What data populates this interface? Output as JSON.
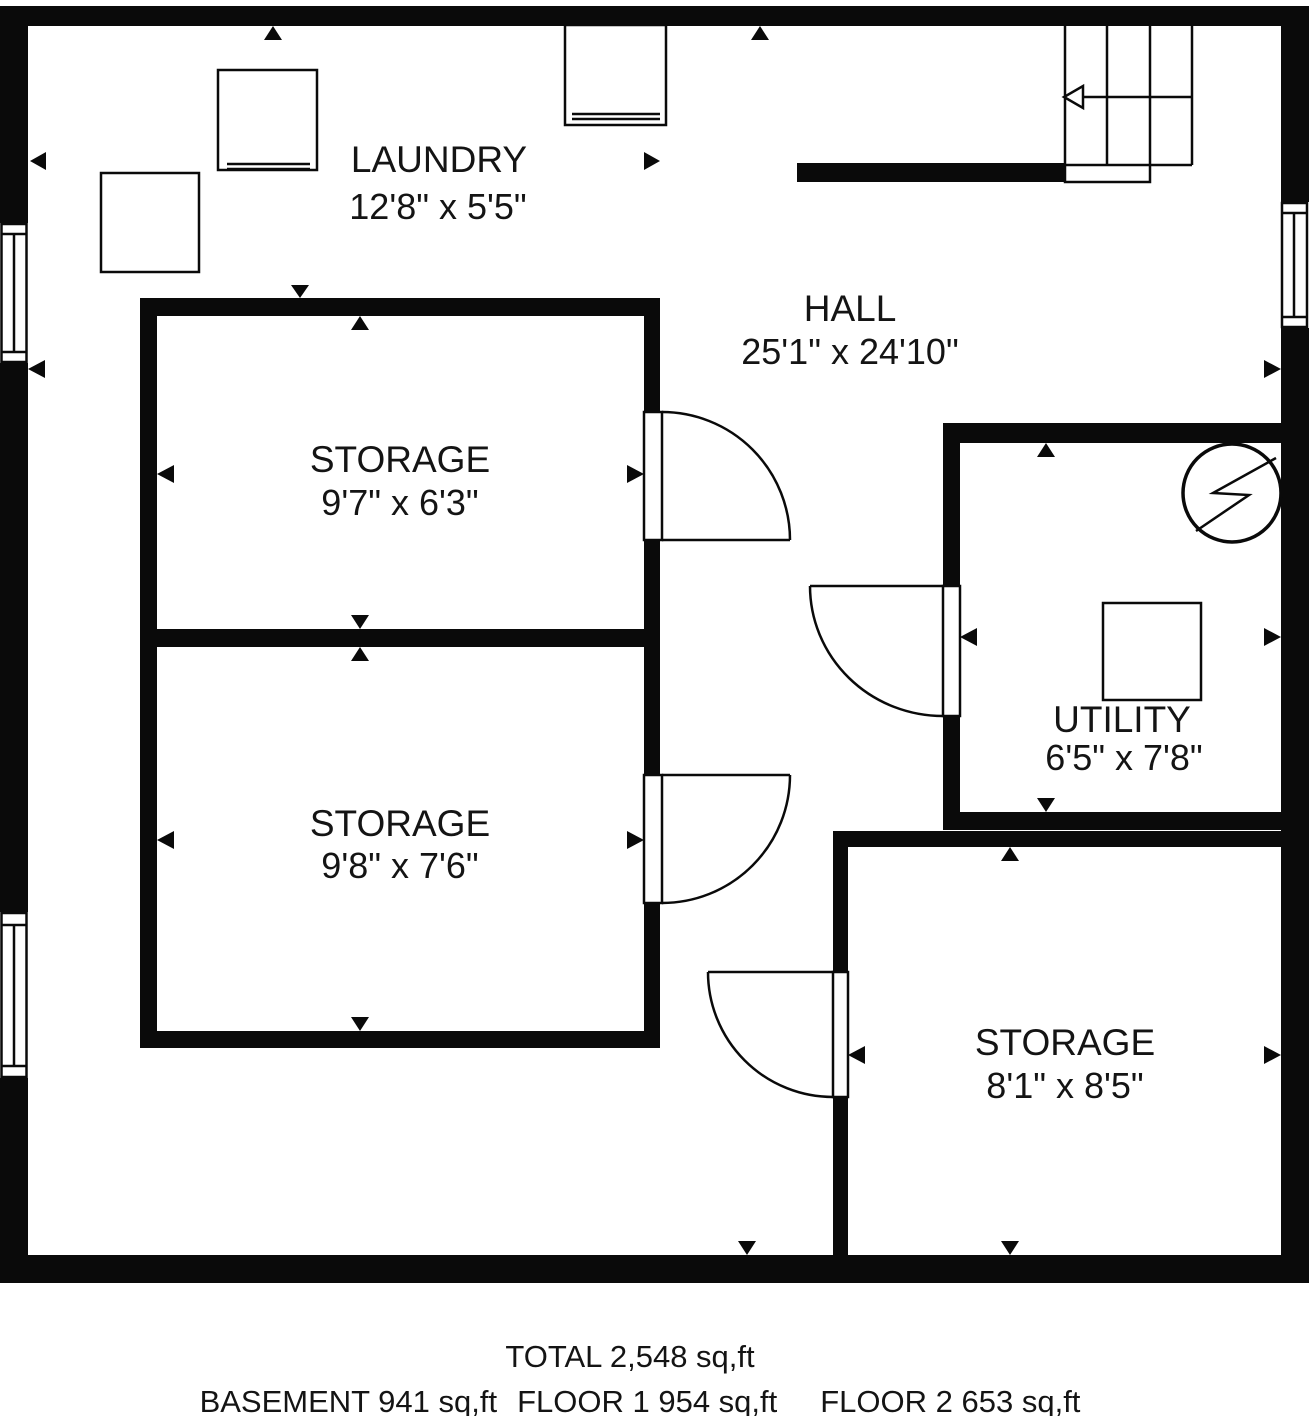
{
  "floorplan": {
    "rooms": [
      {
        "name": "LAUNDRY",
        "dims": "12'8\" x 5'5\""
      },
      {
        "name": "HALL",
        "dims": "25'1\" x 24'10\""
      },
      {
        "name": "STORAGE",
        "dims": "9'7\" x 6'3\""
      },
      {
        "name": "STORAGE",
        "dims": "9'8\" x 7'6\""
      },
      {
        "name": "UTILITY",
        "dims": "6'5\" x 7'8\""
      },
      {
        "name": "STORAGE",
        "dims": "8'1\" x 8'5\""
      }
    ],
    "summary": {
      "total": "TOTAL 2,548 sq,ft",
      "basement": "BASEMENT 941 sq,ft",
      "floor1": "FLOOR 1 954 sq,ft",
      "floor2": "FLOOR 2 653 sq,ft"
    },
    "colors": {
      "wall": "#0a0a0a",
      "background": "#ffffff",
      "text": "#141414"
    },
    "icons": {
      "staircase": "staircase-icon",
      "electric_meter": "electric-meter-icon",
      "window": "window-icon",
      "door": "door-swing-icon",
      "appliance": "appliance-icon",
      "measure_arrow": "measure-arrow-icon"
    }
  }
}
